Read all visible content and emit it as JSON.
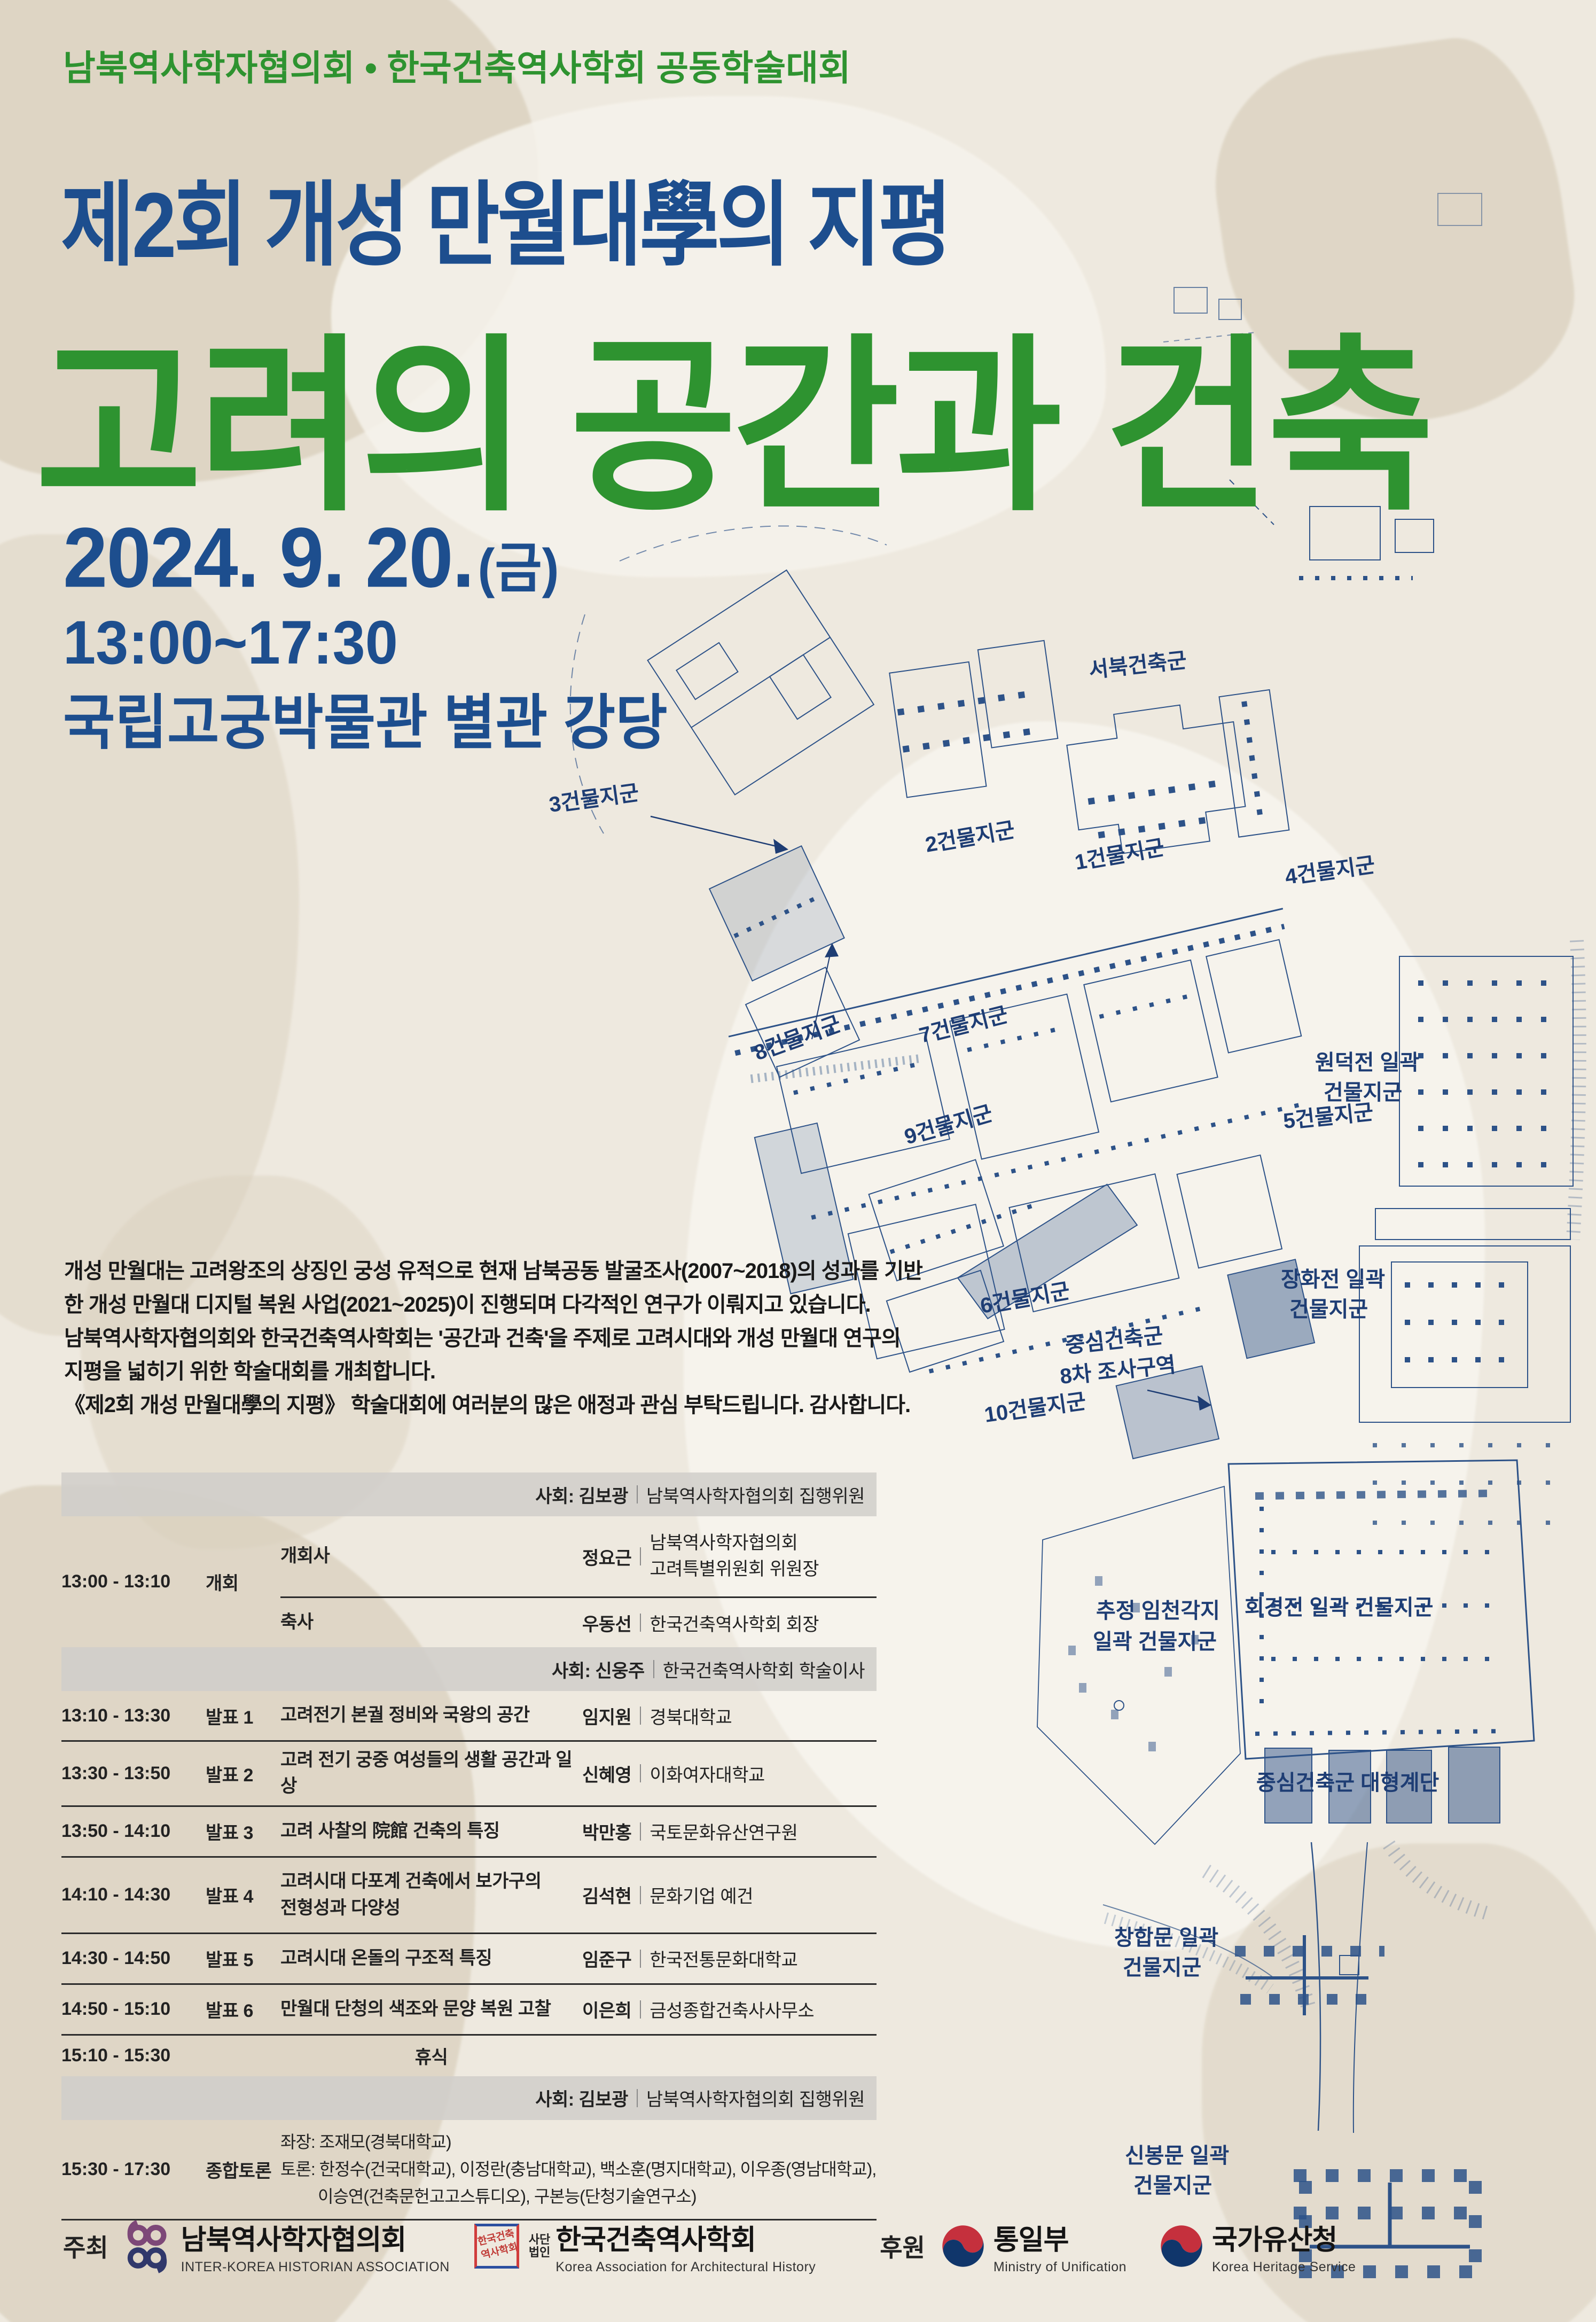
{
  "colors": {
    "green": "#2e9330",
    "navy": "#1d4e8e",
    "map_blue": "#2d5288",
    "band_gray": "#d0cec8",
    "paper": "#eee9df"
  },
  "header": {
    "supertitle": "남북역사학자협의회 • 한국건축역사학회 공동학술대회",
    "subtitle": "제2회 개성 만월대學의 지평",
    "title": "고려의 공간과 건축",
    "date": "2024. 9. 20.",
    "date_suffix": "(금)",
    "time": "13:00~17:30",
    "venue": "국립고궁박물관 별관 강당"
  },
  "intro": {
    "lines": [
      "개성 만월대는 고려왕조의 상징인 궁성 유적으로 현재 남북공동 발굴조사(2007~2018)의 성과를 기반",
      "한 개성 만월대 디지털 복원 사업(2021~2025)이 진행되며 다각적인 연구가 이뤄지고 있습니다.",
      "남북역사학자협의회와 한국건축역사학회는 '공간과 건축'을 주제로 고려시대와 개성 만월대 연구의",
      "지평을 넓히기 위한 학술대회를 개최합니다.",
      "《제2회 개성 만월대學의 지평》 학술대회에 여러분의 많은 애정과 관심 부탁드립니다. 감사합니다."
    ]
  },
  "map": {
    "labels": [
      {
        "lines": [
          "서북건축군"
        ]
      },
      {
        "lines": [
          "3건물지군"
        ]
      },
      {
        "lines": [
          "2건물지군"
        ]
      },
      {
        "lines": [
          "1건물지군"
        ]
      },
      {
        "lines": [
          "4건물지군"
        ]
      },
      {
        "lines": [
          "8건물지군"
        ]
      },
      {
        "lines": [
          "7건물지군"
        ]
      },
      {
        "lines": [
          "원덕전 일곽",
          "건물지군"
        ]
      },
      {
        "lines": [
          "5건물지군"
        ]
      },
      {
        "lines": [
          "9건물지군"
        ]
      },
      {
        "lines": [
          "6건물지군"
        ]
      },
      {
        "lines": [
          "장화전 일곽",
          "건물지군"
        ]
      },
      {
        "lines": [
          "중심건축군",
          "8차 조사구역"
        ]
      },
      {
        "lines": [
          "10건물지군"
        ]
      },
      {
        "lines": [
          "추정 임천각지",
          "일곽 건물지군"
        ]
      },
      {
        "lines": [
          "회경전 일곽 건물지군"
        ]
      },
      {
        "lines": [
          "중심건축군 대형계단"
        ]
      },
      {
        "lines": [
          "창합문 일곽",
          "건물지군"
        ]
      },
      {
        "lines": [
          "신봉문 일곽",
          "건물지군"
        ]
      }
    ]
  },
  "schedule": {
    "bands": [
      {
        "name": "사회: 김보광",
        "affil": "남북역사학자협의회 집행위원"
      },
      {
        "name": "사회: 신웅주",
        "affil": "한국건축역사학회 학술이사"
      },
      {
        "name": "사회: 김보광",
        "affil": "남북역사학자협의회 집행위원"
      }
    ],
    "opening": {
      "time": "13:00 - 13:10",
      "category": "개회",
      "items": [
        {
          "role": "개회사",
          "name": "정요근",
          "affil_lines": [
            "남북역사학자협의회",
            "고려특별위원회 위원장"
          ]
        },
        {
          "role": "축사",
          "name": "우동선",
          "affil_lines": [
            "한국건축역사학회 회장"
          ]
        }
      ]
    },
    "presentations": [
      {
        "time": "13:10 - 13:30",
        "category": "발표 1",
        "title_lines": [
          "고려전기 본궐 정비와 국왕의 공간"
        ],
        "name": "임지원",
        "affil": "경북대학교"
      },
      {
        "time": "13:30 - 13:50",
        "category": "발표 2",
        "title_lines": [
          "고려 전기 궁중 여성들의 생활 공간과 일상"
        ],
        "name": "신혜영",
        "affil": "이화여자대학교"
      },
      {
        "time": "13:50 - 14:10",
        "category": "발표 3",
        "title_lines": [
          "고려 사찰의 院館 건축의 특징"
        ],
        "name": "박만홍",
        "affil": "국토문화유산연구원"
      },
      {
        "time": "14:10 - 14:30",
        "category": "발표 4",
        "title_lines": [
          "고려시대 다포계 건축에서 보가구의",
          "전형성과 다양성"
        ],
        "name": "김석현",
        "affil": "문화기업 예건"
      },
      {
        "time": "14:30 - 14:50",
        "category": "발표 5",
        "title_lines": [
          "고려시대 온돌의 구조적 특징"
        ],
        "name": "임준구",
        "affil": "한국전통문화대학교"
      },
      {
        "time": "14:50 - 15:10",
        "category": "발표 6",
        "title_lines": [
          "만월대 단청의 색조와 문양 복원 고찰"
        ],
        "name": "이은희",
        "affil": "금성종합건축사사무소"
      }
    ],
    "break_row": {
      "time": "15:10 - 15:30",
      "label": "휴식"
    },
    "discussion": {
      "time": "15:30 - 17:30",
      "category": "종합토론",
      "lines": [
        "좌장: 조재모(경북대학교)",
        "토론: 한정수(건국대학교), 이정란(충남대학교), 백소훈(명지대학교), 이우종(영남대학교),",
        "이승연(건축문헌고고스튜디오), 구본능(단청기술연구소)"
      ]
    }
  },
  "footer": {
    "host_label": "주최",
    "hosts": [
      {
        "name": "남북역사학자협의회",
        "en": "INTER-KOREA HISTORIAN ASSOCIATION"
      },
      {
        "prefix1": "사단",
        "prefix2": "법인",
        "name": "한국건축역사학회",
        "en": "Korea Association for Architectural History",
        "seal": "한국건축역사학회"
      }
    ],
    "sponsor_label": "후원",
    "sponsors": [
      {
        "name": "통일부",
        "en": "Ministry of Unification"
      },
      {
        "name": "국가유산청",
        "en": "Korea Heritage Service"
      }
    ]
  }
}
